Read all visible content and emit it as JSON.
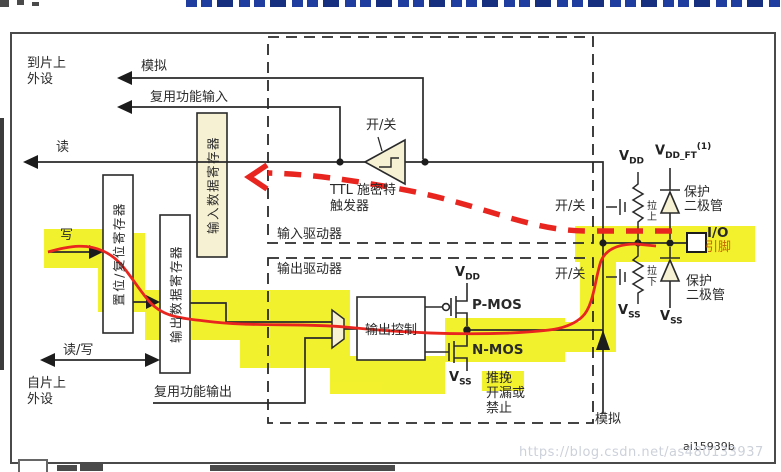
{
  "figure": {
    "id": "ai15939b",
    "watermark": "https://blog.csdn.net/as480133937"
  },
  "colors": {
    "highlight_yellow": "#f0ee00",
    "path_red": "#e8251f",
    "title_blue": "#1e3d9e",
    "symbol_cream": "#f6f1d3"
  },
  "left_labels": {
    "to_peripheral_line1": "到片上",
    "to_peripheral_line2": "外设",
    "analog": "模拟",
    "af_input": "复用功能输入",
    "read": "读",
    "write": "写",
    "read_write": "读/写",
    "from_peripheral_line1": "自片上",
    "from_peripheral_line2": "外设",
    "af_output": "复用功能输出"
  },
  "registers": {
    "input_data": "输入数据寄存器",
    "bit_set_reset": "置位/复位寄存器",
    "output_data": "输出数据寄存器"
  },
  "drivers": {
    "input_driver": "输入驱动器",
    "output_driver": "输出驱动器",
    "on_off": "开/关",
    "schmitt_line1": "TTL 施密特",
    "schmitt_line2": "触发器",
    "output_control": "输出控制",
    "pmos": "P-MOS",
    "nmos": "N-MOS",
    "mode_line1": "推挽",
    "mode_line2": "开漏或",
    "mode_line3": "禁止",
    "analog_bottom": "模拟"
  },
  "power": {
    "v": "V",
    "dd": "DD",
    "ss": "SS",
    "dd_ft": "DD_FT",
    "ft_note": "(1)"
  },
  "pin_area": {
    "pull_up": "拉上",
    "pull_down": "拉下",
    "protect_line1": "保护",
    "protect_line2": "二极管",
    "io": "I/O",
    "pin_word": "引脚"
  }
}
